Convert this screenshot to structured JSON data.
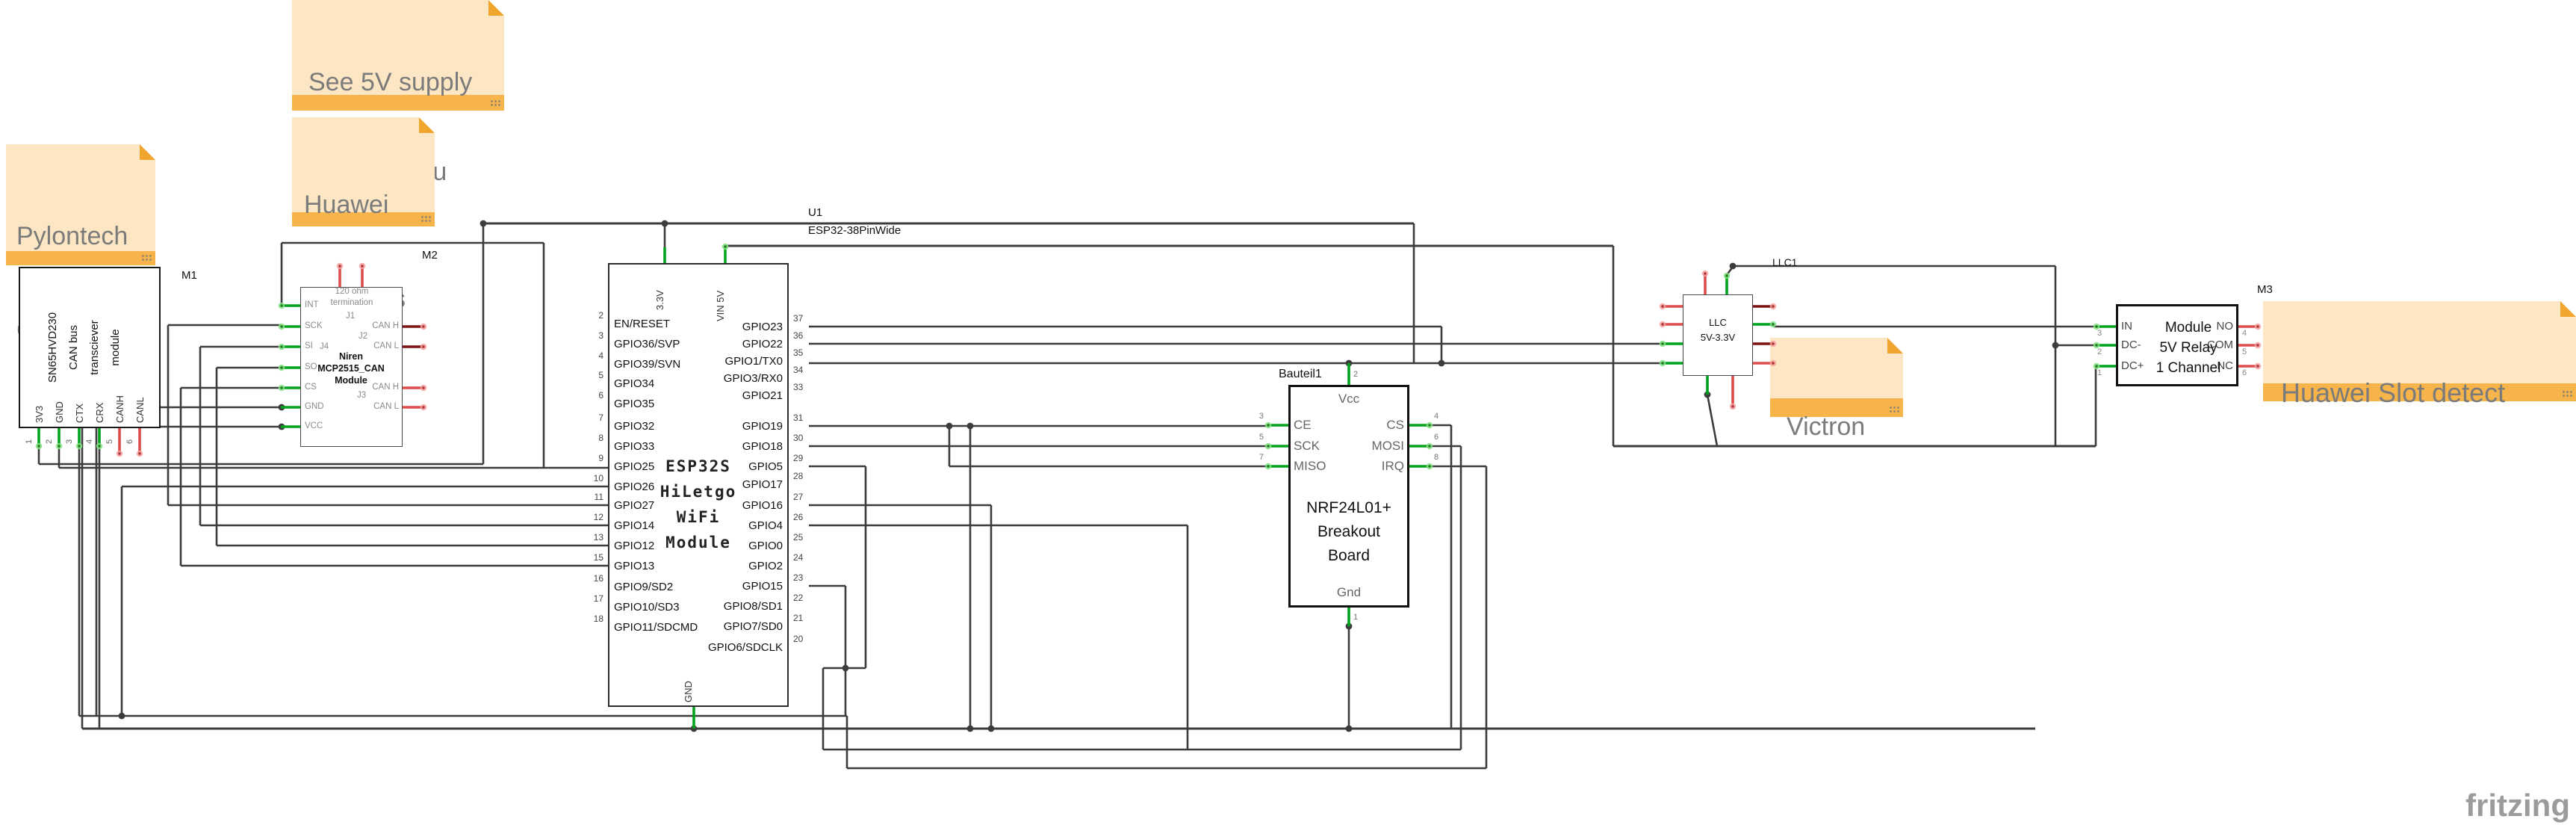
{
  "notes": {
    "see5v": {
      "lines": [
        "See 5V supply",
        "mod in docu"
      ]
    },
    "pylontech": {
      "lines": [
        "Pylontech",
        "CAN bus"
      ]
    },
    "huawei_can": {
      "lines": [
        "Huawei",
        "CAN bus"
      ]
    },
    "victron": {
      "lines": [
        "Victron"
      ]
    },
    "huawei_slot": {
      "lines": [
        "Huawei Slot detect"
      ]
    }
  },
  "components": {
    "m1": {
      "ref": "M1",
      "body_lines": [
        "SN65HVD230",
        "CAN bus",
        "transciever",
        "module"
      ],
      "pins": [
        {
          "n": "1",
          "label": "3V3",
          "c": "green"
        },
        {
          "n": "2",
          "label": "GND",
          "c": "green"
        },
        {
          "n": "3",
          "label": "CTX",
          "c": "green"
        },
        {
          "n": "4",
          "label": "CRX",
          "c": "green"
        },
        {
          "n": "5",
          "label": "CANH",
          "c": "red"
        },
        {
          "n": "6",
          "label": "CANL",
          "c": "red"
        }
      ]
    },
    "m2": {
      "ref": "M2",
      "top_note": [
        "120 ohm",
        "termination"
      ],
      "jumpers": [
        "J1",
        "J2",
        "J4",
        "J3"
      ],
      "name_lines": [
        "Niren",
        "MCP2515_CAN",
        "Module"
      ],
      "left_pins": [
        "INT",
        "SCK",
        "SI",
        "SO",
        "CS",
        "GND",
        "VCC"
      ],
      "right_pins": [
        "CAN H",
        "CAN L",
        "CAN H",
        "CAN L"
      ]
    },
    "u1": {
      "ref": "U1",
      "part": "ESP32-38PinWide",
      "center_lines": [
        "ESP32S",
        "HiLetgo",
        "WiFi",
        "Module"
      ],
      "top_pins": [
        "3.3V",
        "VIN 5V"
      ],
      "bottom_pin": "GND",
      "left_pins": [
        {
          "n": "2",
          "label": "EN/RESET",
          "c": "red"
        },
        {
          "n": "3",
          "label": "GPIO36/SVP",
          "c": "red"
        },
        {
          "n": "4",
          "label": "GPIO39/SVN",
          "c": "red"
        },
        {
          "n": "5",
          "label": "GPIO34",
          "c": "red"
        },
        {
          "n": "6",
          "label": "GPIO35",
          "c": "red"
        },
        {
          "n": "7",
          "label": "GPIO32",
          "c": "red"
        },
        {
          "n": "8",
          "label": "GPIO33",
          "c": "red"
        },
        {
          "n": "9",
          "label": "GPIO25",
          "c": "green"
        },
        {
          "n": "10",
          "label": "GPIO26",
          "c": "green"
        },
        {
          "n": "11",
          "label": "GPIO27",
          "c": "green"
        },
        {
          "n": "12",
          "label": "GPIO14",
          "c": "green"
        },
        {
          "n": "13",
          "label": "GPIO12",
          "c": "green"
        },
        {
          "n": "15",
          "label": "GPIO13",
          "c": "green"
        },
        {
          "n": "16",
          "label": "GPIO9/SD2",
          "c": "red"
        },
        {
          "n": "17",
          "label": "GPIO10/SD3",
          "c": "red"
        },
        {
          "n": "18",
          "label": "GPIO11/SDCMD",
          "c": "red"
        }
      ],
      "right_pins": [
        {
          "n": "37",
          "label": "GPIO23",
          "c": "green"
        },
        {
          "n": "36",
          "label": "GPIO22",
          "c": "green"
        },
        {
          "n": "35",
          "label": "GPIO1/TX0",
          "c": "green"
        },
        {
          "n": "34",
          "label": "GPIO3/RX0",
          "c": "red"
        },
        {
          "n": "33",
          "label": "GPIO21",
          "c": "red"
        },
        {
          "n": "31",
          "label": "GPIO19",
          "c": "green"
        },
        {
          "n": "30",
          "label": "GPIO18",
          "c": "green"
        },
        {
          "n": "29",
          "label": "GPIO5",
          "c": "green"
        },
        {
          "n": "28",
          "label": "GPIO17",
          "c": "red"
        },
        {
          "n": "27",
          "label": "GPIO16",
          "c": "green"
        },
        {
          "n": "26",
          "label": "GPIO4",
          "c": "green"
        },
        {
          "n": "25",
          "label": "GPIO0",
          "c": "red"
        },
        {
          "n": "24",
          "label": "GPIO2",
          "c": "red"
        },
        {
          "n": "23",
          "label": "GPIO15",
          "c": "green"
        },
        {
          "n": "22",
          "label": "GPIO8/SD1",
          "c": "red"
        },
        {
          "n": "21",
          "label": "GPIO7/SD0",
          "c": "red"
        },
        {
          "n": "20",
          "label": "GPIO6/SDCLK",
          "c": "red"
        }
      ]
    },
    "nrf": {
      "ref": "Bauteil1",
      "center_lines": [
        "NRF24L01+",
        "Breakout",
        "Board"
      ],
      "top_pin": {
        "n": "2",
        "label": "Vcc"
      },
      "bottom_pin": {
        "n": "1",
        "label": "Gnd"
      },
      "left_pins": [
        {
          "n": "3",
          "label": "CE"
        },
        {
          "n": "5",
          "label": "SCK"
        },
        {
          "n": "7",
          "label": "MISO"
        }
      ],
      "right_pins": [
        {
          "n": "4",
          "label": "CS"
        },
        {
          "n": "6",
          "label": "MOSI"
        },
        {
          "n": "8",
          "label": "IRQ"
        }
      ]
    },
    "llc": {
      "ref": "LLC1",
      "lines": [
        "LLC",
        "5V-3.3V"
      ]
    },
    "m3": {
      "ref": "M3",
      "center_lines": [
        "Module",
        "5V Relay",
        "1 Channel"
      ],
      "left_pins": [
        {
          "n": "3",
          "label": "IN"
        },
        {
          "n": "2",
          "label": "DC-"
        },
        {
          "n": "1",
          "label": "DC+"
        }
      ],
      "right_pins": [
        {
          "n": "4",
          "label": "NO"
        },
        {
          "n": "5",
          "label": "COM"
        },
        {
          "n": "6",
          "label": "NC"
        }
      ]
    }
  },
  "logo": "fritzing",
  "colors": {
    "wire": "#3C3C3C",
    "pin_green": "#00A31C",
    "pin_red": "#DE4B4B",
    "pin_darkred": "#7E1313",
    "note_bg": "#FCE6C3",
    "note_bar": "#F6B44B",
    "note_fold": "#F0A52E",
    "note_text": "#7B7B7B",
    "logo_text": "#9B9B9B"
  }
}
